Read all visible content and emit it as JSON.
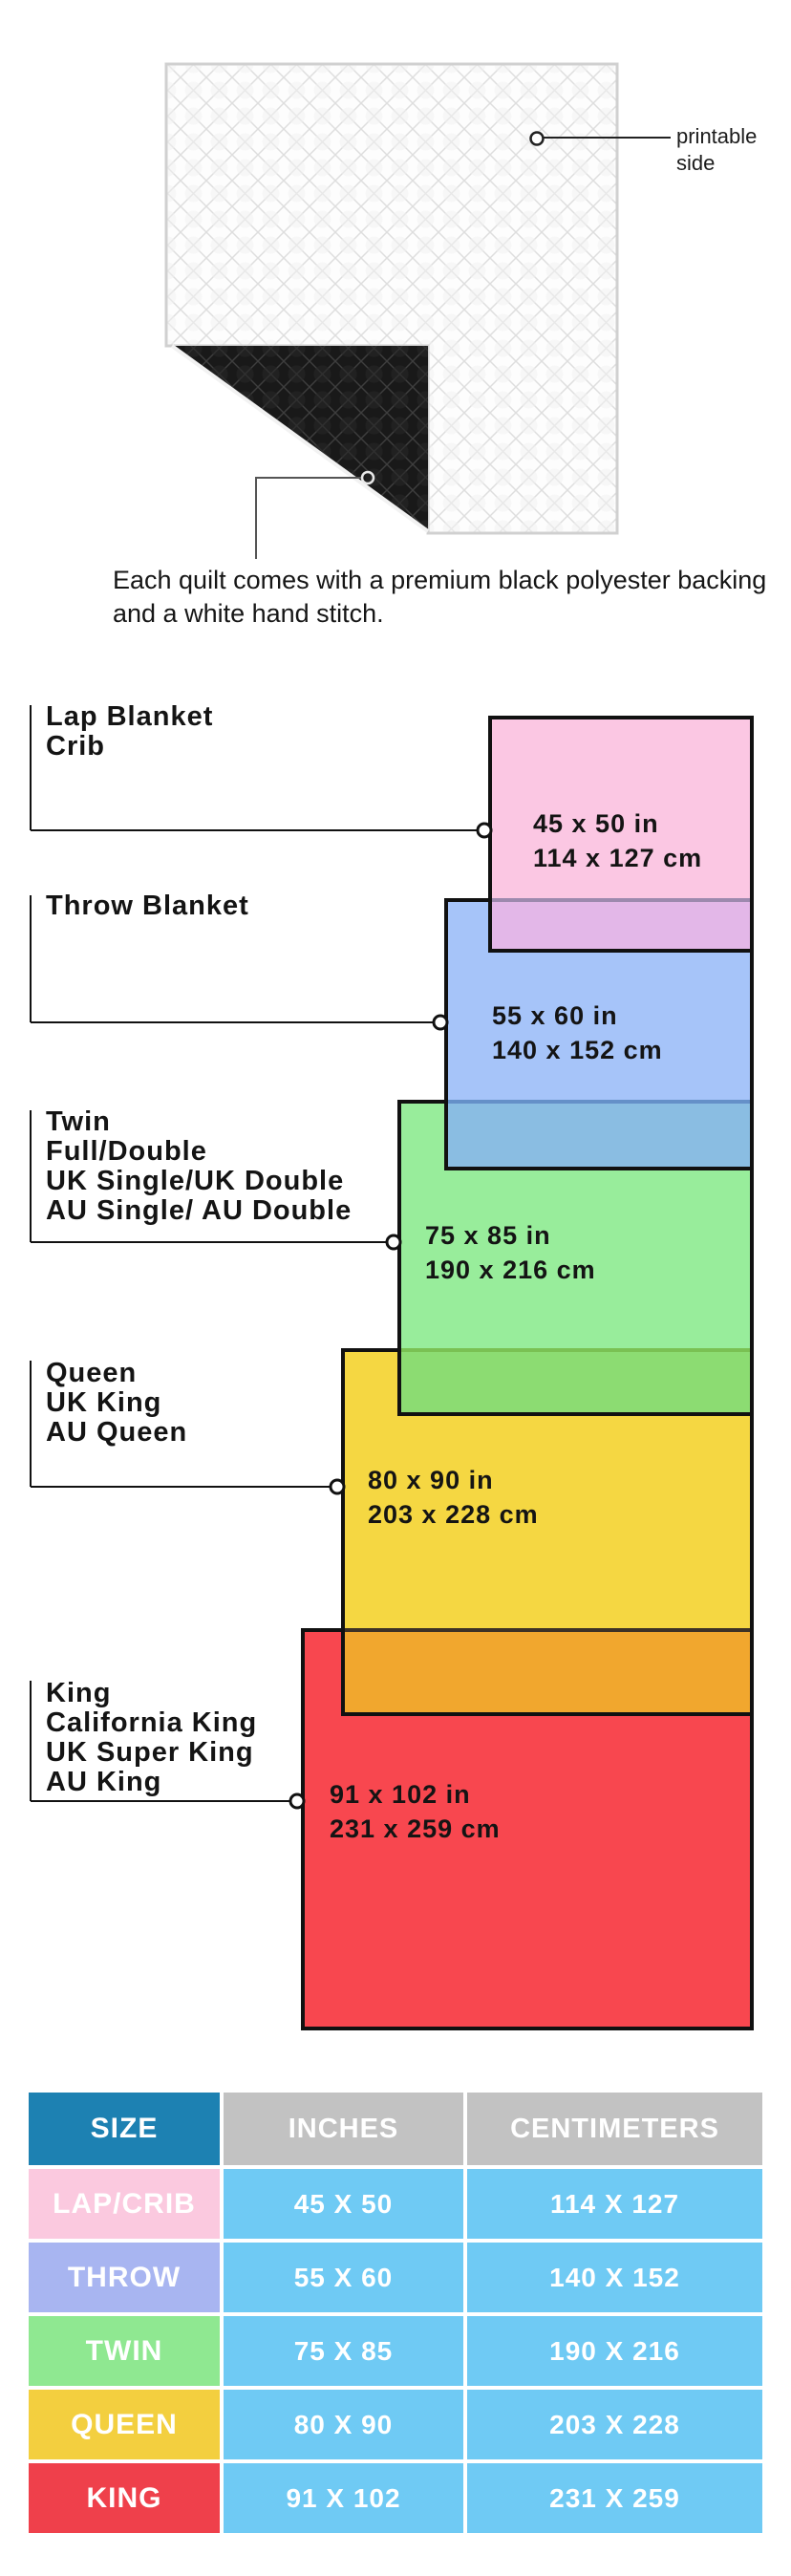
{
  "top_section": {
    "printable_side_label": "printable side",
    "description": "Each quilt comes with a premium black polyester backing and a white hand stitch."
  },
  "colors": {
    "pink": "#fbc7e3",
    "pink_blue_overlap": "#e3b7e8",
    "blue": "#a6c4f9",
    "blue_green_overlap": "#8abde2",
    "green": "#98ed9b",
    "green_yellow_overlap": "#8cdc72",
    "yellow": "#f5d742",
    "yellow_red_overlap": "#f1a72e",
    "red": "#f8474f",
    "border_black": "#111111",
    "table_header_blue": "#1d81b2",
    "table_header_gray": "#c2c2c2",
    "table_value_blue": "#6fcaf4",
    "table_row_pink": "#fbc9df",
    "table_row_periwinkle": "#a8b5f1",
    "table_row_green": "#8fe891",
    "table_row_yellow": "#f3cf3f",
    "table_row_red": "#ef404b",
    "quilt_backing_black": "#191919"
  },
  "diagram": {
    "groups": [
      {
        "lines": [
          "Lap Blanket",
          "Crib"
        ],
        "inches": "45 x 50 in",
        "cm": "114 x 127 cm"
      },
      {
        "lines": [
          "Throw Blanket"
        ],
        "inches": "55 x 60 in",
        "cm": "140 x 152 cm"
      },
      {
        "lines": [
          "Twin",
          "Full/Double",
          "UK Single/UK Double",
          "AU Single/ AU Double"
        ],
        "inches": "75 x 85 in",
        "cm": "190 x 216 cm"
      },
      {
        "lines": [
          "Queen",
          "UK King",
          "AU Queen"
        ],
        "inches": "80 x 90 in",
        "cm": "203 x 228 cm"
      },
      {
        "lines": [
          "King",
          "California King",
          "UK Super King",
          "AU King"
        ],
        "inches": "91 x 102 in",
        "cm": "231 x 259 cm"
      }
    ]
  },
  "table": {
    "headers": {
      "size": "SIZE",
      "inches": "INCHES",
      "cm": "CENTIMETERS"
    },
    "rows": [
      {
        "size": "LAP/CRIB",
        "inches": "45 X 50",
        "cm": "114 X 127"
      },
      {
        "size": "THROW",
        "inches": "55 X 60",
        "cm": "140 X 152"
      },
      {
        "size": "TWIN",
        "inches": "75 X 85",
        "cm": "190 X 216"
      },
      {
        "size": "QUEEN",
        "inches": "80 X 90",
        "cm": "203 X 228"
      },
      {
        "size": "KING",
        "inches": "91 X 102",
        "cm": "231 X 259"
      }
    ]
  }
}
